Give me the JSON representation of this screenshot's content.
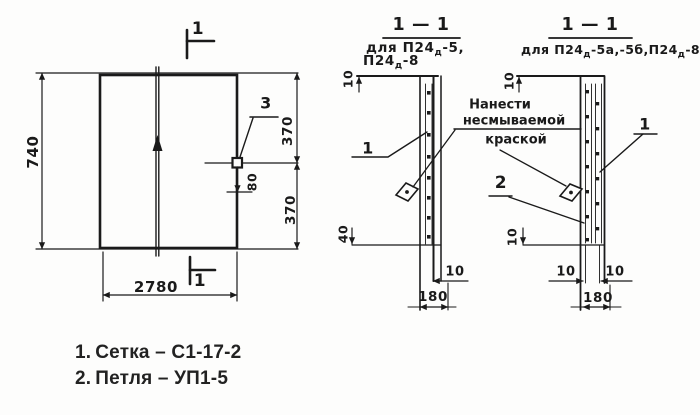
{
  "drawing": {
    "plan": {
      "mark_top": "1",
      "mark_bottom": "1",
      "dim_height": "740",
      "dim_width": "2780",
      "dim_right_top": "370",
      "dim_right_mid": "80",
      "dim_right_bottom": "370",
      "callout_detail": "3"
    },
    "section_a": {
      "title": "1 — 1",
      "subtitle_line1": {
        "pre": "для ",
        "base": "П24",
        "sub": "д",
        "post": "-5,"
      },
      "subtitle_line2": {
        "base": "П24",
        "sub": "д",
        "post": "-8"
      },
      "dim_top": "10",
      "dim_mesh_bottom": "40",
      "dim_edge": "10",
      "dim_thickness": "180",
      "callout_mesh": "1"
    },
    "section_b": {
      "title": "1 — 1",
      "subtitle": {
        "pre": "для ",
        "base1": "П24",
        "sub1": "д",
        "mid": "-5а,-5б,",
        "base2": "П24",
        "sub2": "д",
        "post": "-8а"
      },
      "dim_top": "10",
      "dim_mesh_bottom": "10",
      "dim_edge_left": "10",
      "dim_edge_right": "10",
      "dim_thickness": "180",
      "callout_mesh": "1",
      "callout_loop": "2"
    },
    "annotation": {
      "line1": "Нанести",
      "line2": "несмываемой",
      "line3": "краской"
    },
    "legend": {
      "items": [
        {
          "num": "1.",
          "label": "Сетка – С1-17-2"
        },
        {
          "num": "2.",
          "label": "Петля – УП1-5"
        }
      ]
    }
  }
}
